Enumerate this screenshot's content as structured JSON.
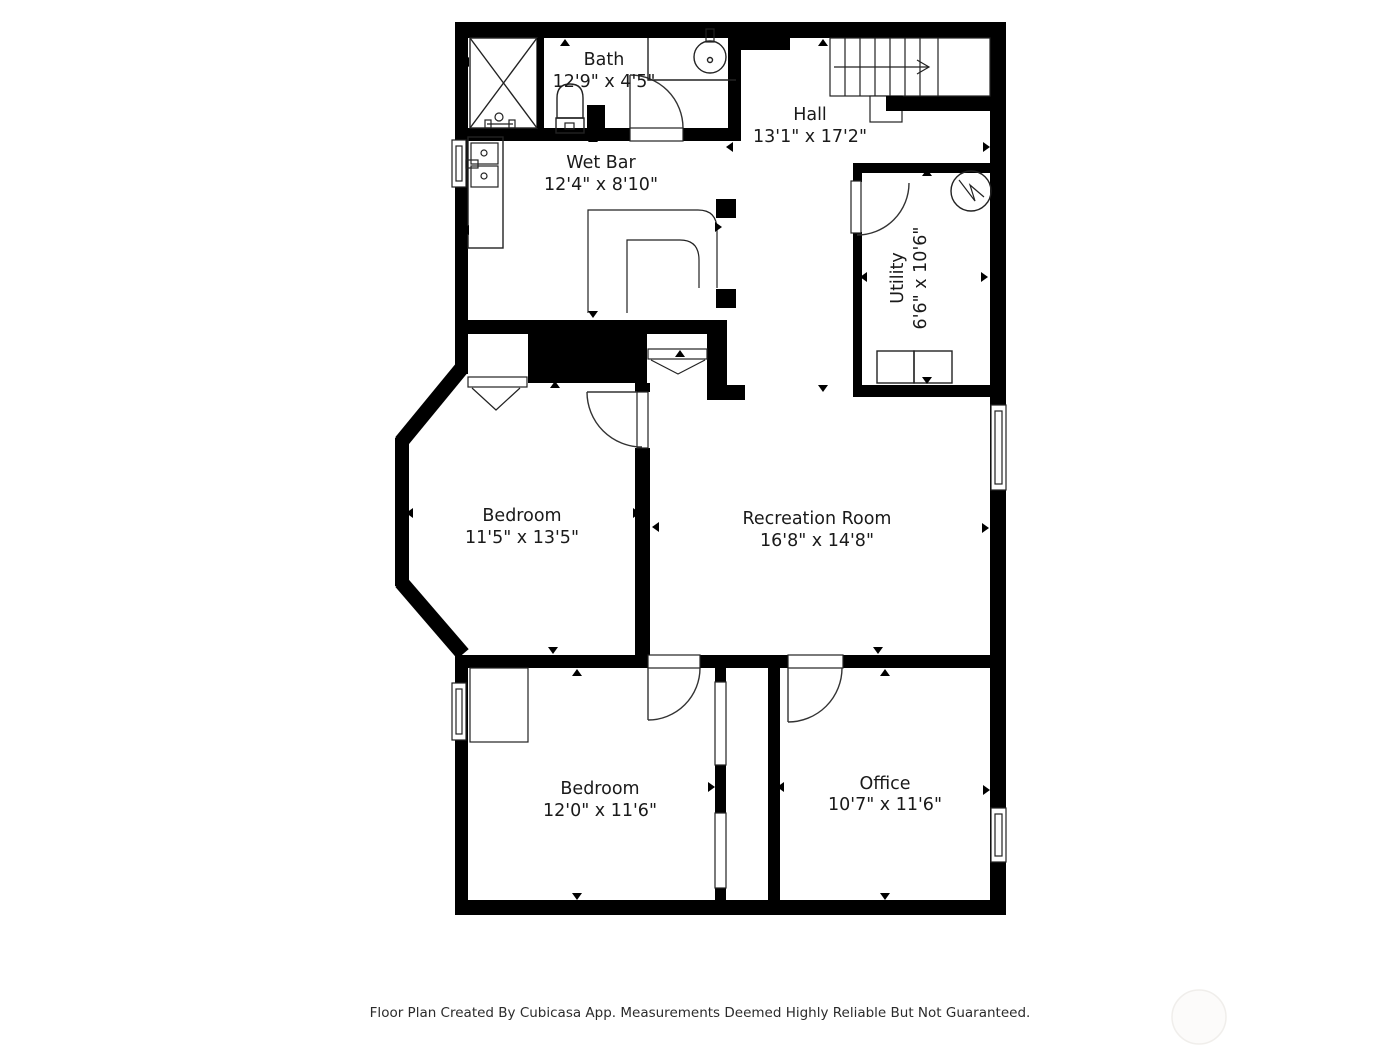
{
  "plan": {
    "rooms": [
      {
        "name": "Bath",
        "dims": "12'9\" x 4'5\""
      },
      {
        "name": "Hall",
        "dims": "13'1\" x 17'2\""
      },
      {
        "name": "Wet Bar",
        "dims": "12'4\" x 8'10\""
      },
      {
        "name": "Utility",
        "dims": "6'6\" x 10'6\""
      },
      {
        "name": "Bedroom",
        "dims": "11'5\" x 13'5\""
      },
      {
        "name": "Recreation Room",
        "dims": "16'8\" x 14'8\""
      },
      {
        "name": "Bedroom",
        "dims": "12'0\" x 11'6\""
      },
      {
        "name": "Office",
        "dims": "10'7\" x 11'6\""
      }
    ],
    "footer": "Floor Plan Created By Cubicasa App. Measurements Deemed Highly Reliable But Not Guaranteed.",
    "colors": {
      "wall": "#000000",
      "background": "#ffffff",
      "text": "#1a1a1a",
      "line": "#222222",
      "watermark": "#f5f3f0"
    }
  }
}
